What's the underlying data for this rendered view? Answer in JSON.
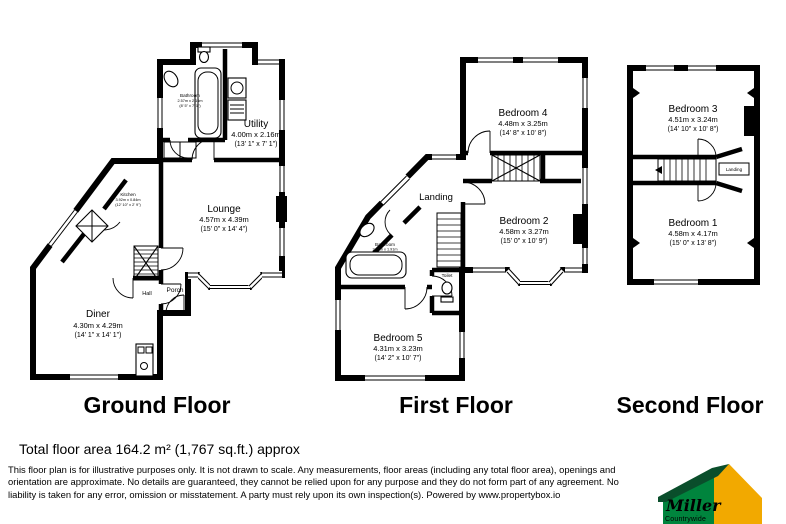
{
  "floors": [
    {
      "title": "Ground Floor",
      "rooms": {
        "bathroom": {
          "name": "Bathroom",
          "metric": "2.57m x 2.16m",
          "imperial": "(8' 5\" x 7' 1\")"
        },
        "utility": {
          "name": "Utility",
          "metric": "4.00m x 2.16m",
          "imperial": "(13' 1\" x 7' 1\")"
        },
        "lounge": {
          "name": "Lounge",
          "metric": "4.57m x 4.39m",
          "imperial": "(15' 0\" x 14' 4\")"
        },
        "kitchen": {
          "name": "Kitchen",
          "metric": "3.92m x 0.84m",
          "imperial": "(12' 10\" x 2' 9\")"
        },
        "diner": {
          "name": "Diner",
          "metric": "4.30m x 4.29m",
          "imperial": "(14' 1\" x 14' 1\")"
        },
        "hall": {
          "name": "Hall"
        },
        "porch": {
          "name": "Porch"
        }
      }
    },
    {
      "title": "First Floor",
      "rooms": {
        "bedroom4": {
          "name": "Bedroom 4",
          "metric": "4.48m x 3.25m",
          "imperial": "(14' 8\" x 10' 8\")"
        },
        "bedroom2": {
          "name": "Bedroom 2",
          "metric": "4.58m x 3.27m",
          "imperial": "(15' 0\" x 10' 9\")"
        },
        "bedroom5": {
          "name": "Bedroom 5",
          "metric": "4.31m x 3.23m",
          "imperial": "(14' 2\" x 10' 7\")"
        },
        "landing": {
          "name": "Landing"
        },
        "bathroom": {
          "name": "Bathroom",
          "metric": "2.06m x 1.91m",
          "imperial": "(6' 9\" x 6' 3\")"
        },
        "toilet": {
          "name": "Toilet"
        }
      }
    },
    {
      "title": "Second Floor",
      "rooms": {
        "bedroom3": {
          "name": "Bedroom 3",
          "metric": "4.51m x 3.24m",
          "imperial": "(14' 10\" x 10' 8\")"
        },
        "bedroom1": {
          "name": "Bedroom 1",
          "metric": "4.58m x 4.17m",
          "imperial": "(15' 0\" x 13' 8\")"
        },
        "landing": {
          "name": "Landing"
        }
      }
    }
  ],
  "footer": {
    "total_area": "Total floor area 164.2 m² (1,767 sq.ft.) approx",
    "disclaimer_lines": [
      "This floor plan is for illustrative purposes only. It is not drawn to scale. Any measurements, floor areas (including any total floor area), openings and",
      "orientation are approximate. No details are guaranteed, they cannot be relied upon for any purpose and they do not form part of any agreement. No",
      "liability is taken for any error, omission or misstatement. A party must rely upon its own inspection(s). Powered by www.propertybox.io"
    ]
  },
  "logo": {
    "brand": "Miller",
    "sub": "Countrywide",
    "colors": {
      "green": "#00843d",
      "dark_green": "#0a4e2b",
      "yellow": "#f2a900",
      "sub_text": "#c8d545"
    }
  }
}
